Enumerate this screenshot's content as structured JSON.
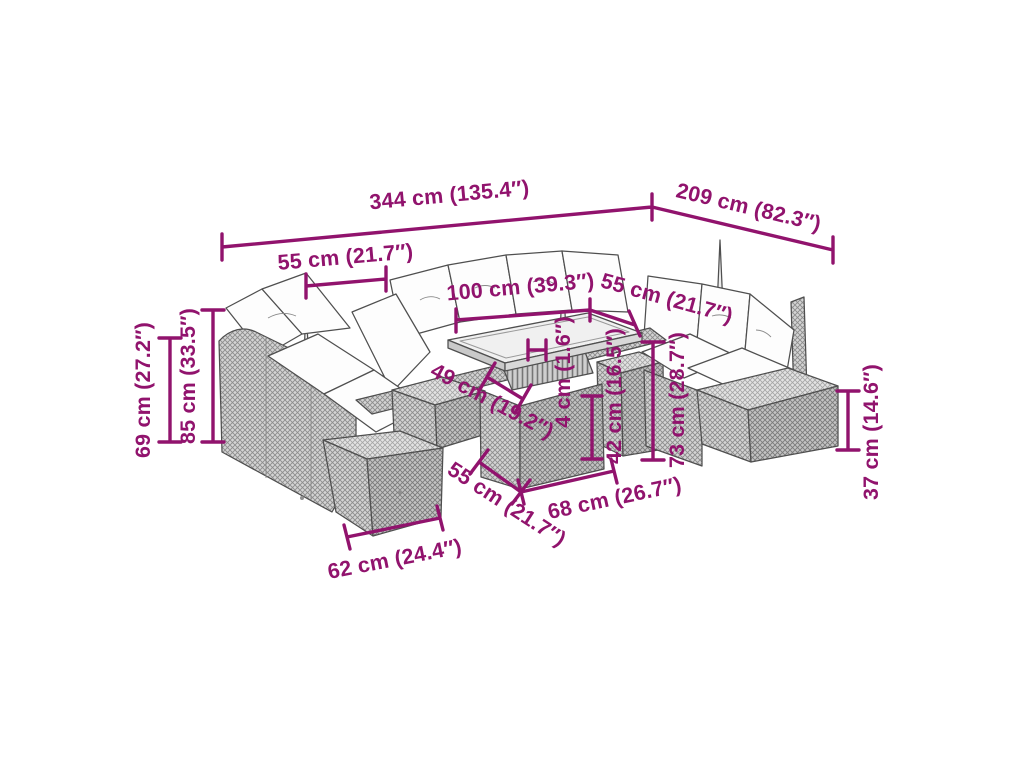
{
  "page": {
    "background": "#ffffff",
    "subject": "rattan-garden-sofa-set-dimension-diagram"
  },
  "colors": {
    "dimension_accent": "#91136D",
    "outline": "#4f4f4f",
    "wicker_fill": "#d4d4d4",
    "wicker_weave": "#8c8c8c",
    "cushion": "#fdfdfd"
  },
  "dims": {
    "overall_width": {
      "label": "344 cm (135.4″)"
    },
    "overall_depth": {
      "label": "209 cm (82.3″)"
    },
    "seat_width_back": {
      "label": "55 cm (21.7″)"
    },
    "table_width": {
      "label": "100 cm (39.3″)"
    },
    "seat_width_right": {
      "label": "55 cm (21.7″)"
    },
    "arm_height": {
      "label": "69 cm (27.2″)"
    },
    "back_height": {
      "label": "85 cm (33.5″)"
    },
    "seat_depth": {
      "label": "49 cm (19.2″)"
    },
    "tabletop_thickness": {
      "label": "4 cm (1.6″)"
    },
    "table_leg_height": {
      "label": "42 cm (16.5″)"
    },
    "table_height": {
      "label": "73 cm (28.7″)"
    },
    "stool_height": {
      "label": "37 cm (14.6″)"
    },
    "table_depth": {
      "label": "55 cm (21.7″)"
    },
    "table_base_width": {
      "label": "68 cm (26.7″)"
    },
    "stool_width": {
      "label": "62 cm (24.4″)"
    }
  }
}
